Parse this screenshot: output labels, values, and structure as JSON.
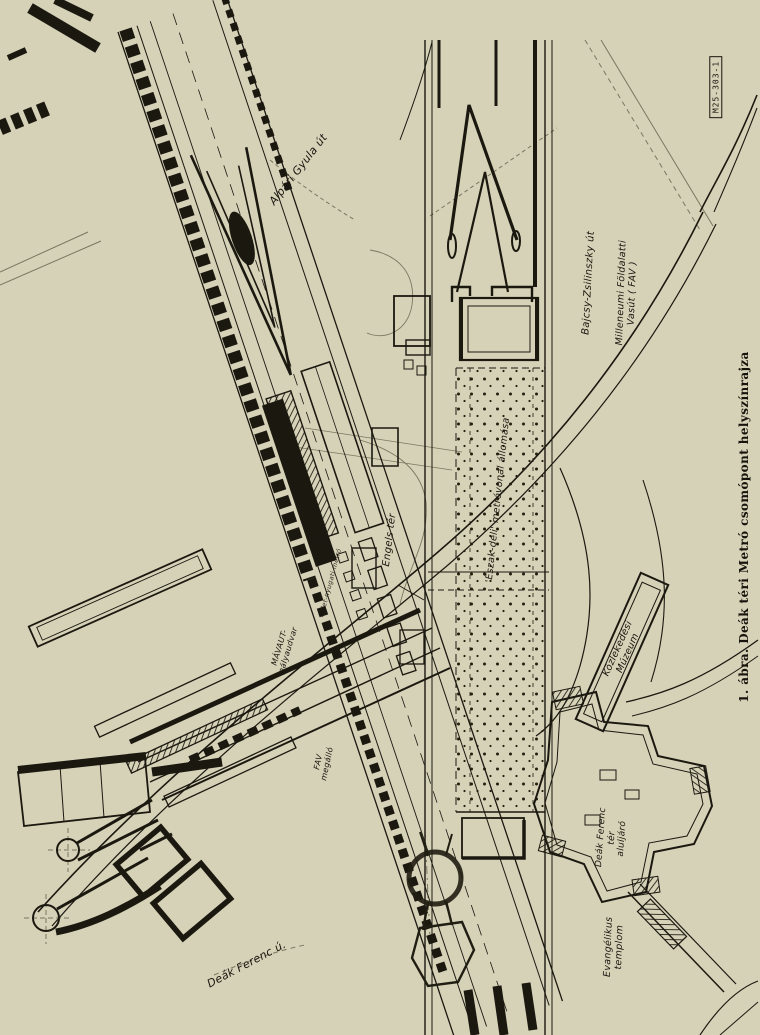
{
  "figure": {
    "caption": "1. ábra. Deák téri Metró csomópont helyszínrajza",
    "drawing_code": "M25-303-1",
    "type": "site-plan engineering drawing, rotated 90°"
  },
  "colors": {
    "paper_background": "#d6d2b8",
    "ink": "#1b1810",
    "faint_construction_lines": "#7a7660"
  },
  "labels": {
    "alpari_gyula_ut": "Alpári Gyula út",
    "bajcsy_zsilinszky_ut": "Bajcsy-Zsilinszky út",
    "milleneumi_fav": "Milleneumi Földalatti Vasút ( FAV )",
    "engels_ter": "Engels tér",
    "eszak_deli_allomas": "'Észak-déli' metróvonal állomása",
    "kelet_nyugati_metro": "Kelet-nyugati metró",
    "mavaut_palyaudvar": "MÁVAUT-\npályaudvar",
    "fav_megallo": "FAV\nmegálló",
    "kozlekedesi_muzeum": "Közlekedési\nMúzeum",
    "deak_ferenc_ter_aluljaro": "Deák Ferenc\ntér\naluljáró",
    "evangelikus_templom": "Evangélikus\ntemplom",
    "deak_ferenc_u": "Deák Ferenc ú."
  }
}
